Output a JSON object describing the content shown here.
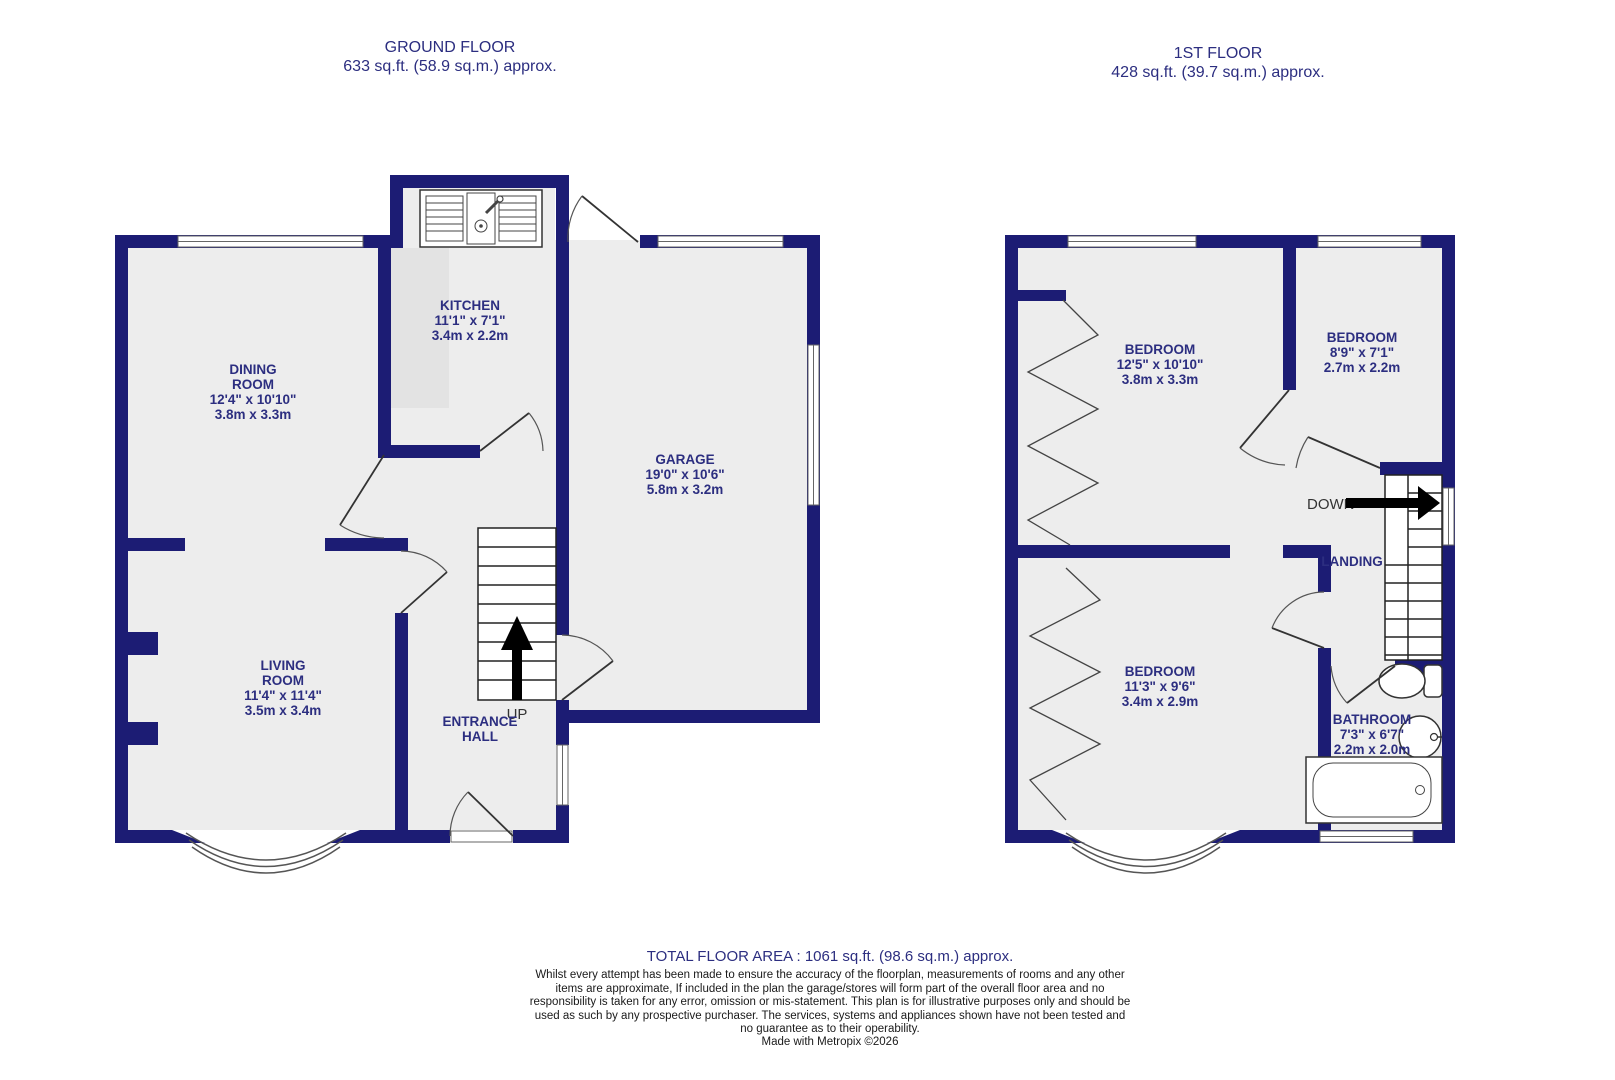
{
  "colors": {
    "wall": "#1c1c74",
    "label": "#2c2e80"
  },
  "titles": {
    "ground": {
      "name": "GROUND FLOOR",
      "area": "633 sq.ft. (58.9 sq.m.) approx."
    },
    "first": {
      "name": "1ST FLOOR",
      "area": "428 sq.ft. (39.7 sq.m.) approx."
    }
  },
  "rooms": {
    "dining": {
      "name": "DINING\nROOM",
      "imperial": "12'4\" x 10'10\"",
      "metric": "3.8m x 3.3m"
    },
    "kitchen": {
      "name": "KITCHEN",
      "imperial": "11'1\" x 7'1\"",
      "metric": "3.4m x 2.2m"
    },
    "garage": {
      "name": "GARAGE",
      "imperial": "19'0\" x 10'6\"",
      "metric": "5.8m x 3.2m"
    },
    "living": {
      "name": "LIVING\nROOM",
      "imperial": "11'4\" x 11'4\"",
      "metric": "3.5m x 3.4m"
    },
    "entrance": {
      "name": "ENTRANCE\nHALL"
    },
    "bedroom1": {
      "name": "BEDROOM",
      "imperial": "12'5\" x 10'10\"",
      "metric": "3.8m x 3.3m"
    },
    "bedroom2": {
      "name": "BEDROOM",
      "imperial": "8'9\" x 7'1\"",
      "metric": "2.7m x 2.2m"
    },
    "bedroom3": {
      "name": "BEDROOM",
      "imperial": "11'3\" x 9'6\"",
      "metric": "3.4m x 2.9m"
    },
    "bathroom": {
      "name": "BATHROOM",
      "imperial": "7'3\" x 6'7\"",
      "metric": "2.2m x 2.0m"
    },
    "landing": {
      "name": "LANDING"
    }
  },
  "stairs": {
    "up": "UP",
    "down": "DOWN"
  },
  "footer": {
    "total": "TOTAL FLOOR AREA : 1061 sq.ft. (98.6 sq.m.) approx.",
    "disclaimer": "Whilst every attempt has been made to ensure the accuracy of the floorplan, measurements of rooms and any other items are approximate, If included in the plan the garage/stores will form part of the overall floor area and no responsibility is taken for any error, omission or mis-statement. This plan is for illustrative purposes only and should be used as such by any prospective purchaser. The services, systems and appliances shown have not been tested and no guarantee as to their operability.",
    "credit": "Made with Metropix ©2026"
  }
}
